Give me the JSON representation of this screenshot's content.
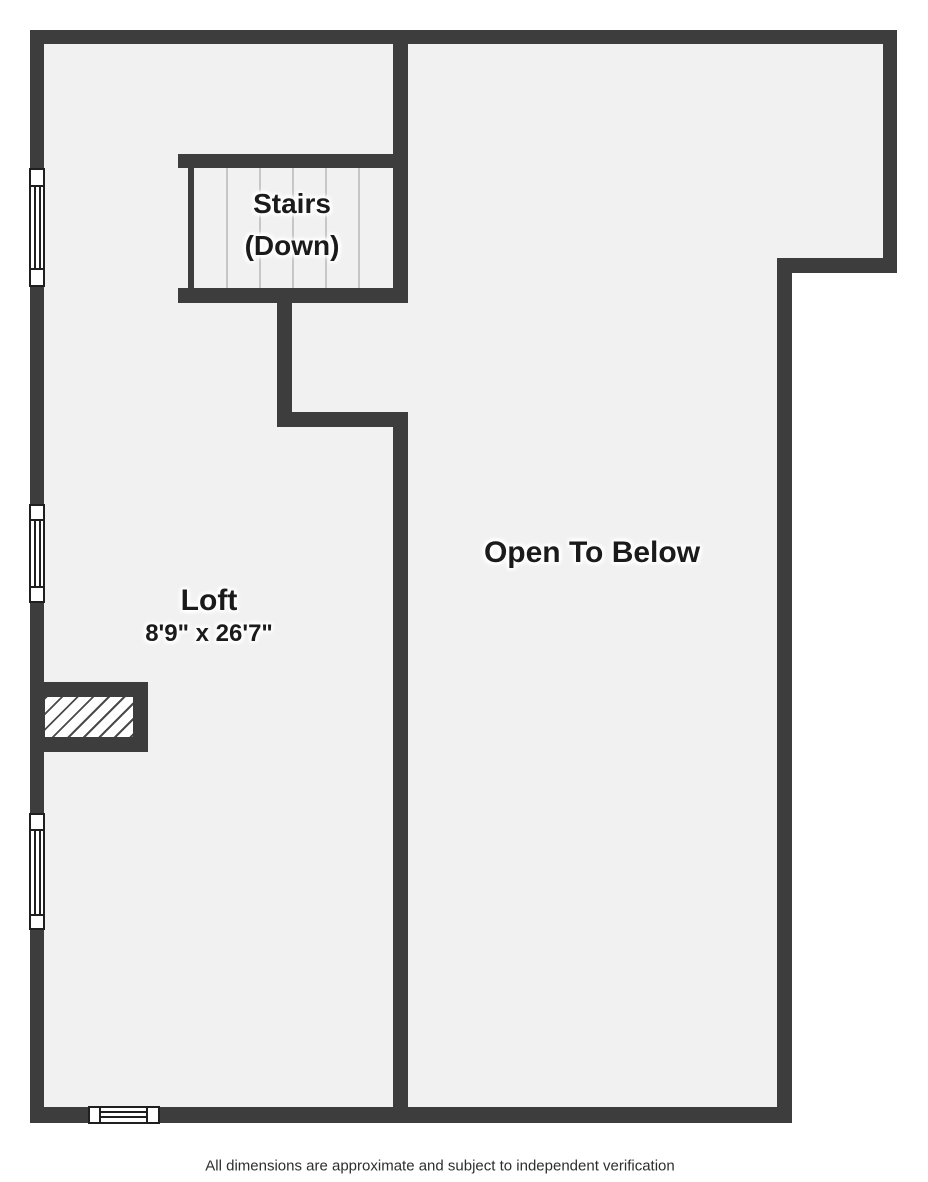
{
  "floor_plan": {
    "rooms": [
      {
        "name": "stairs",
        "label_line1": "Stairs",
        "label_line2": "(Down)"
      },
      {
        "name": "loft",
        "label": "Loft",
        "dimensions": "8'9\" x 26'7\""
      },
      {
        "name": "open-to-below",
        "label": "Open To Below"
      }
    ],
    "disclaimer": "All dimensions are approximate and subject to independent verification",
    "symbols": {
      "windows_left_wall": 3,
      "windows_bottom_wall": 1,
      "stair_tread_lines": 5,
      "chimney_hatched": 1
    },
    "colors": {
      "wall": "#3d3d3d",
      "floor": "#f1f1f1",
      "outside": "#ffffff",
      "tread_line": "#c6c6c6",
      "window_border": "#1f1f1f",
      "hatch_line": "#4a4a4a",
      "label_text": "#1b1b1b",
      "disclaimer_text": "#2e2e2e"
    }
  }
}
